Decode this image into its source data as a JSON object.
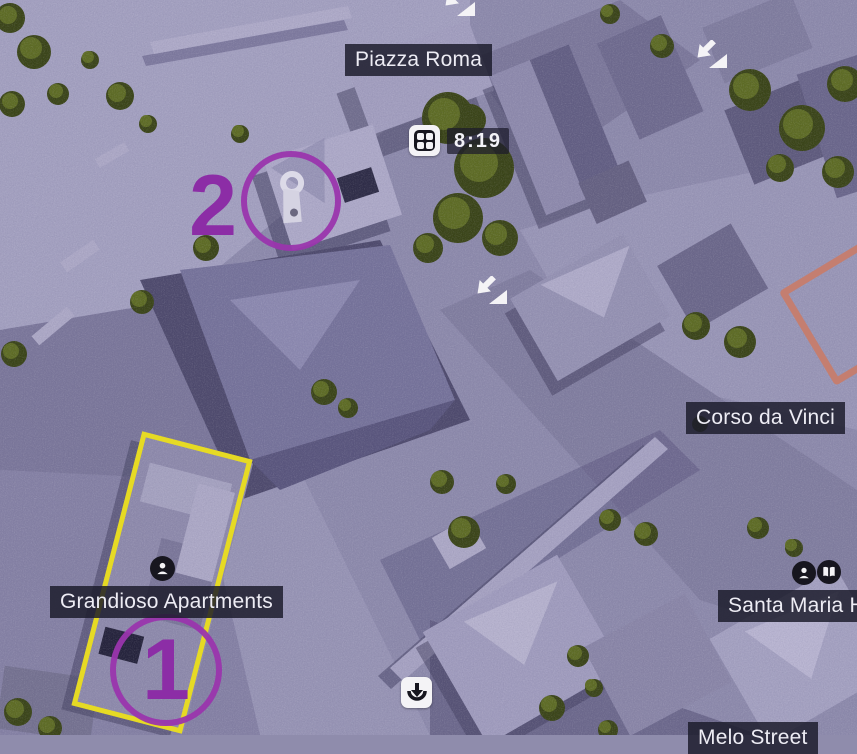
{
  "labels": {
    "piazza_roma": "Piazza Roma",
    "corso_da_vinci": "Corso da Vinci",
    "grandioso_apartments": "Grandioso Apartments",
    "santa_maria": "Santa Maria Ho",
    "melo_street": "Melo Street"
  },
  "timer": {
    "time": "8:19"
  },
  "markers": {
    "objective_one": "1",
    "objective_two": "2"
  },
  "icons": {
    "timer_icon": "van-grid-icon",
    "entry_icons": "entry-arrow-icon (x3)",
    "deploy_icon": "deploy-point-icon",
    "person_icons": "person-icon (x2)",
    "book_icon": "intel-book-icon",
    "pin_icon": "character-pin-icon"
  },
  "colors": {
    "objective_purple": "#9a35ad",
    "deploy_zone_yellow": "#e6da24",
    "zone_salmon": "#c47e70",
    "label_background": "#1c1b2b",
    "hud_icon_background": "#f4f3f6",
    "map_tint": "#8f8cac"
  }
}
